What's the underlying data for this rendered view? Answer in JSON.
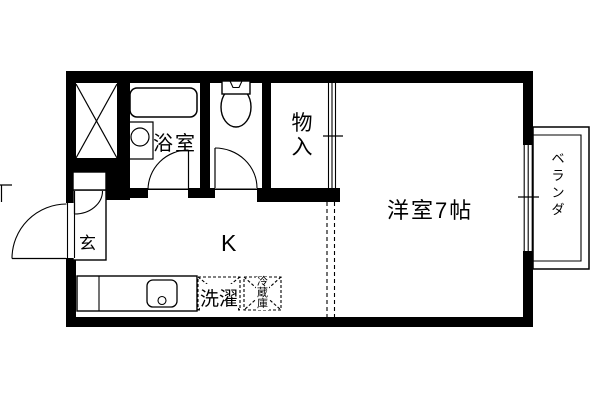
{
  "floorplan": {
    "colors": {
      "wall": "#000000",
      "background": "#ffffff",
      "line": "#000000"
    },
    "rooms": {
      "bathroom": {
        "label": "浴室"
      },
      "closet": {
        "label": "物入"
      },
      "western_room": {
        "label": "洋室7帖"
      },
      "veranda": {
        "label": "ベランダ"
      },
      "entrance": {
        "label": "玄"
      },
      "kitchen": {
        "label": "K"
      }
    },
    "appliances": {
      "washer": {
        "label": "洗濯"
      },
      "refrigerator": {
        "label": "冷蔵庫"
      }
    }
  }
}
